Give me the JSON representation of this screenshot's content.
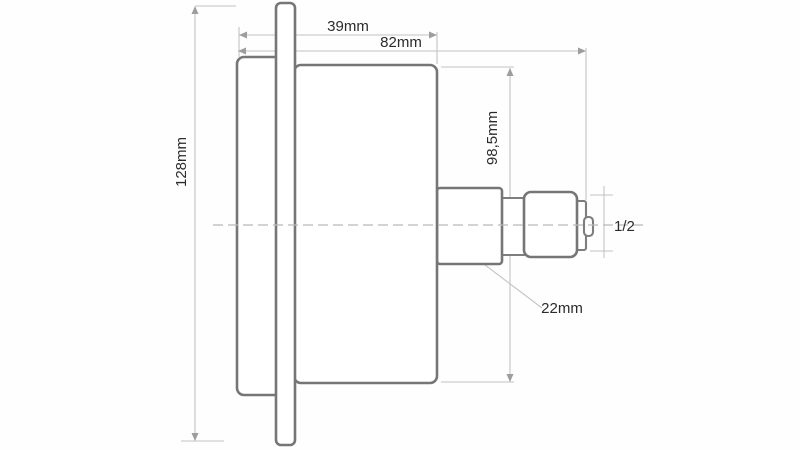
{
  "diagram": {
    "type": "technical-drawing",
    "subject": "pressure-gauge-side-view-panel-mount",
    "background_color": "#fefefe",
    "outline_color": "#767676",
    "dimension_line_color": "#c3c3c3",
    "centerline_color": "#b9b9b9",
    "text_color": "#2b2b2b",
    "labels": {
      "depth_case": "39mm",
      "depth_total": "82mm",
      "case_height": "98,5mm",
      "flange_height": "128mm",
      "connection_length": "22mm",
      "thread_size": "1/2"
    }
  }
}
